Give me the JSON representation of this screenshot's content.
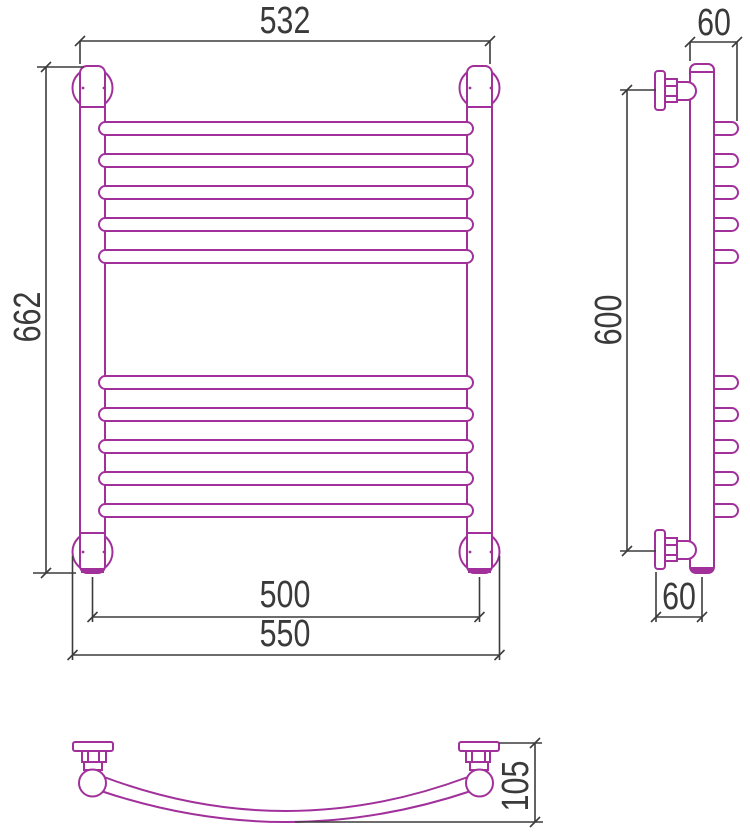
{
  "page": {
    "background": "#ffffff"
  },
  "drawing": {
    "line_color": "#a1309b",
    "dimension_color": "#3c3c3c",
    "rungs_front_view": 10,
    "rungs_side_view": 10,
    "dimensions": {
      "front_top_width": "532",
      "front_height": "662",
      "front_rail_axis_width": "500",
      "front_overall_width": "550",
      "side_top_depth": "60",
      "side_height": "600",
      "side_bottom_depth": "60",
      "bottom_bow_depth": "105"
    }
  }
}
